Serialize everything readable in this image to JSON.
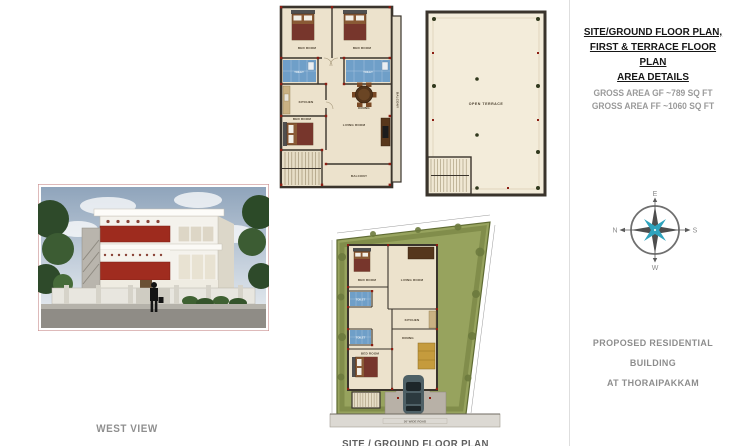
{
  "header": {
    "title_lines": [
      "SITE/GROUND FLOOR PLAN,",
      "FIRST & TERRACE FLOOR PLAN",
      "AREA DETAILS"
    ],
    "gross_area_gf": "GROSS AREA GF ~789 SQ FT",
    "gross_area_ff": "GROSS AREA FF ~1060 SQ FT"
  },
  "project": {
    "line1": "PROPOSED RESIDENTIAL BUILDING",
    "line2": "AT THORAIPAKKAM"
  },
  "compass": {
    "east": "E",
    "south": "S",
    "west": "W",
    "north": "N"
  },
  "west_view": {
    "caption": "WEST VIEW"
  },
  "first_floor_plan": {
    "bed_room_1": "BED ROOM",
    "bed_room_2": "BED ROOM",
    "toilet_1": "TOILET",
    "toilet_2": "TOILET",
    "kitchen": "KITCHEN",
    "dining": "DINING",
    "living_room": "LIVING ROOM",
    "bed_room_3": "BED ROOM",
    "balcony_right": "BALCONY",
    "balcony_bottom": "BALCONY"
  },
  "terrace_plan": {
    "label": "OPEN TERRACE"
  },
  "site_plan": {
    "caption": "SITE / GROUND FLOOR PLAN",
    "road_label": "30' WIDE ROAD",
    "bed_room_1": "BED ROOM",
    "living_room": "LIVING ROOM",
    "toilet_1": "TOILET",
    "kitchen": "KITCHEN",
    "toilet_2": "TOILET",
    "dining": "DINING",
    "bed_room_2": "BED ROOM"
  },
  "colors": {
    "accent_red": "#9e2b1e",
    "plan_wall": "#3a342c",
    "plan_floor": "#ece2cc",
    "bath_blue": "#6f9fc8",
    "lawn_green": "#97a35e",
    "compass_teal": "#2fa3bd",
    "title_black": "#161616",
    "text_gray": "#8f8f8f"
  }
}
